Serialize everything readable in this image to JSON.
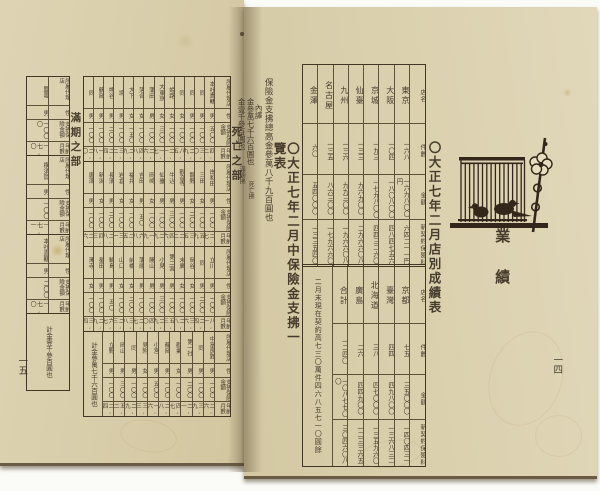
{
  "colors": {
    "paper": "#d8cdab",
    "ink": "#3b3022"
  },
  "left_page": {
    "page_number": "一五",
    "title": "〇大正七年二月中保險金支拂一覽表",
    "total_note": "保險金支拂總高金參萬八千九百圓也",
    "breakdown_label": "內譯",
    "breakdown": [
      {
        "amount": "金參萬七千六百圓也",
        "tag": "死亡拂"
      },
      {
        "amount": "金壹千參百圓也",
        "tag": "滿期拂"
      }
    ],
    "death_section": {
      "label": "死亡之部",
      "col_headers": [
        "所屬代理店",
        "性",
        "支拂保險金額",
        "年齡月數"
      ],
      "bands": [
        {
          "records": [
            {
              "agency": "本社直轄",
              "sex": "男",
              "amount": "五〇〇",
              "period": "四,二"
            },
            {
              "agency": "同",
              "sex": "男",
              "amount": "一〇〇",
              "period": "三,〇"
            },
            {
              "agency": "同",
              "sex": "男",
              "amount": "一〇〇",
              "period": "二,九"
            },
            {
              "agency": "同",
              "sex": "女",
              "amount": "一〇〇",
              "period": "八,五"
            },
            {
              "agency": "姫路",
              "sex": "女",
              "amount": "一〇〇",
              "period": "二,一"
            },
            {
              "agency": "大東京",
              "sex": "女",
              "amount": "三〇〇",
              "period": "一,七"
            },
            {
              "agency": "蒲田",
              "sex": "男",
              "amount": "一〇〇",
              "period": "二,六"
            },
            {
              "agency": "落合",
              "sex": "女",
              "amount": "一〇〇",
              "period": "四,八"
            },
            {
              "agency": "大下",
              "sex": "女",
              "amount": "一五〇",
              "period": "二,九"
            },
            {
              "agency": "境",
              "sex": "男",
              "amount": "一〇〇",
              "period": "三,二"
            },
            {
              "agency": "熊谷",
              "sex": "男",
              "amount": "二〇〇",
              "period": "二,四"
            },
            {
              "agency": "鶴岡",
              "sex": "男",
              "amount": "一〇〇",
              "period": "一,八"
            },
            {
              "agency": "同",
              "sex": "男",
              "amount": "一〇〇",
              "period": "二,〇"
            }
          ]
        },
        {
          "records": [
            {
              "agency": "岸和田",
              "sex": "男",
              "amount": "一〇〇",
              "period": "二,七"
            },
            {
              "agency": "三田",
              "sex": "女",
              "amount": "一〇〇",
              "period": "五,九"
            },
            {
              "agency": "龍野",
              "sex": "女",
              "amount": "二〇〇",
              "period": "三,五"
            },
            {
              "agency": "觀音寺",
              "sex": "男",
              "amount": "一〇〇",
              "period": "二,二"
            },
            {
              "agency": "牛込",
              "sex": "男",
              "amount": "三〇〇",
              "period": "四,六"
            },
            {
              "agency": "仙臺",
              "sex": "男",
              "amount": "一〇〇",
              "period": "二,九"
            },
            {
              "agency": "岡崎",
              "sex": "女",
              "amount": "一〇〇",
              "period": "一,九"
            },
            {
              "agency": "吉田",
              "sex": "男",
              "amount": "五〇",
              "period": "六,八"
            },
            {
              "agency": "福井",
              "sex": "女",
              "amount": "一〇〇",
              "period": "二,五"
            },
            {
              "agency": "岩倉",
              "sex": "女",
              "amount": "一〇〇",
              "period": "三,一"
            },
            {
              "agency": "長濱",
              "sex": "男",
              "amount": "二〇〇",
              "period": "二,八"
            },
            {
              "agency": "新潟",
              "sex": "女",
              "amount": "一〇〇",
              "period": "四,三"
            },
            {
              "agency": "唐津",
              "sex": "男",
              "amount": "一〇〇",
              "period": "二,六"
            }
          ]
        },
        {
          "records": [
            {
              "agency": "立川",
              "sex": "男",
              "amount": "一〇〇",
              "period": "八,一"
            },
            {
              "agency": "同",
              "sex": "男",
              "amount": "二〇〇",
              "period": "二,四"
            },
            {
              "agency": "岡谷",
              "sex": "女",
              "amount": "一〇〇",
              "period": "三,六"
            },
            {
              "agency": "末廣",
              "sex": "女",
              "amount": "一〇〇",
              "period": "二,八"
            },
            {
              "agency": "第二宮",
              "sex": "男",
              "amount": "一〇〇",
              "period": "五,三"
            },
            {
              "agency": "小見",
              "sex": "男",
              "amount": "三〇〇",
              "period": "二,九"
            },
            {
              "agency": "勝山",
              "sex": "男",
              "amount": "一〇〇",
              "period": "四,〇"
            },
            {
              "agency": "蒲原",
              "sex": "男",
              "amount": "一〇〇",
              "period": "二,七"
            },
            {
              "agency": "前橋",
              "sex": "女",
              "amount": "二〇〇",
              "period": "三,八"
            },
            {
              "agency": "山口",
              "sex": "女",
              "amount": "一〇〇",
              "period": "二,三"
            },
            {
              "agency": "輪島",
              "sex": "男",
              "amount": "五〇",
              "period": "六,七"
            },
            {
              "agency": "星田",
              "sex": "男",
              "amount": "一〇〇",
              "period": "二,九"
            },
            {
              "agency": "澤寺",
              "sex": "女",
              "amount": "一〇〇",
              "period": "三,四"
            }
          ]
        },
        {
          "total": "計金參萬七千六百圓也",
          "records": [
            {
              "agency": "中富良野",
              "sex": "男",
              "amount": "一〇〇",
              "period": "二,六"
            },
            {
              "agency": "同",
              "sex": "男",
              "amount": "一〇〇",
              "period": "三,九"
            },
            {
              "agency": "第一社",
              "sex": "男",
              "amount": "二〇〇",
              "period": "二,一"
            },
            {
              "agency": "勸業",
              "sex": "女",
              "amount": "一〇〇",
              "period": "四,七"
            },
            {
              "agency": "靜岡",
              "sex": "男",
              "amount": "一〇〇",
              "period": "二,八"
            },
            {
              "agency": "小宮",
              "sex": "男",
              "amount": "五〇〇",
              "period": "一,六"
            },
            {
              "agency": "見附",
              "sex": "女",
              "amount": "一〇〇",
              "period": "三,三"
            },
            {
              "agency": "同",
              "sex": "男",
              "amount": "一〇〇",
              "period": "二,九"
            },
            {
              "agency": "岡山",
              "sex": "男",
              "amount": "三〇〇",
              "period": "五,二"
            },
            {
              "agency": "立野",
              "sex": "男",
              "amount": "一〇〇",
              "period": "二,四"
            }
          ]
        }
      ]
    },
    "maturity_section": {
      "label": "滿期之部",
      "field_labels": [
        "所屬代理店",
        "性",
        "支拂保險金額",
        "年齡月數"
      ],
      "records": [
        {
          "agency": "鹽竈",
          "sex": "男",
          "amount": "一〇〇〇",
          "period": "一七,〇"
        },
        {
          "agency": "横須賀",
          "sex": "男",
          "amount": "一〇〇",
          "period": "一七,一"
        },
        {
          "agency": "本社直轄",
          "sex": "男",
          "amount": "二〇〇",
          "period": "一七,〇"
        }
      ],
      "total": "計金壹千參百圓也"
    }
  },
  "right_page": {
    "page_number": "一四",
    "chapter_title": "業績",
    "title": "〇大正七年二月店別成績表",
    "illustration": "birdcage-with-two-birds-and-plum-branch",
    "table": {
      "col_headers": [
        "店名",
        "件數",
        "金額",
        "新契約保險料"
      ],
      "top_rows": [
        {
          "store": "東京",
          "count": "一六八",
          "amount": "一六九八〇〇円",
          "premium": "六四二一一円"
        },
        {
          "store": "大阪",
          "count": "一〇四",
          "amount": "一八〇八〇〇",
          "premium": "四八四七五六"
        },
        {
          "store": "京城",
          "count": "一九三",
          "amount": "一七九八〇〇",
          "premium": "四四三二六〇"
        },
        {
          "store": "仙臺",
          "count": "一三三",
          "amount": "九六九〇〇",
          "premium": "二九六六〇八"
        },
        {
          "store": "九州",
          "count": "一三六",
          "amount": "九九三〇〇",
          "premium": "一九六六〇八"
        },
        {
          "store": "名古屋",
          "count": "一三五",
          "amount": "八六三〇〇",
          "premium": "一七九六六〇"
        },
        {
          "store": "金澤",
          "count": "六〇",
          "amount": "五四〇〇〇",
          "premium": "一三三五四〇"
        }
      ],
      "bottom_rows": [
        {
          "store": "京都",
          "count": "七五",
          "amount": "三五〇〇〇",
          "premium": "一四〇四三一"
        },
        {
          "store": "臺灣",
          "count": "四四",
          "amount": "四九八〇〇",
          "premium": "一三六八三二"
        },
        {
          "store": "北海道",
          "count": "三八",
          "amount": "四七〇〇〇",
          "premium": "一三五九六〇"
        },
        {
          "store": "廣島",
          "count": "二六",
          "amount": "四四九〇〇",
          "premium": "一二三三六五"
        },
        {
          "store": "合計",
          "count": "一二四〇",
          "amount": "一〇八七七〇〇",
          "premium": "三〇四六〇八"
        }
      ],
      "summary": "二月末現在契約高七三〇萬件四六八五七一〇圓餘"
    }
  }
}
